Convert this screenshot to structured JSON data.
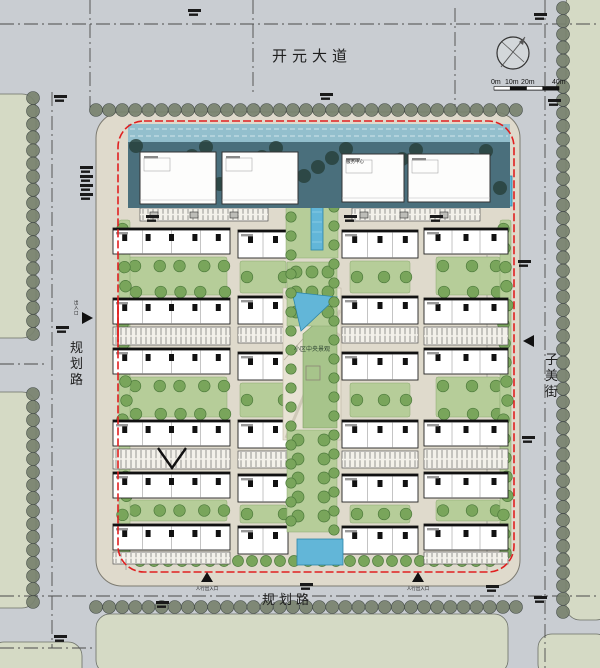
{
  "canvas": {
    "w": 600,
    "h": 668
  },
  "roads": {
    "top": "开元大道",
    "left": "规划路",
    "right": "子美街",
    "bottom": "规划路"
  },
  "scale_bar": {
    "ticks": [
      "0m",
      "10m",
      "20m",
      "40m"
    ]
  },
  "labels": {
    "central_landscape": "小区中央景观",
    "service_center": "服务中心",
    "entrance_west": "出入口",
    "entrance_pedestrian": "人行出入口"
  },
  "colors": {
    "road": "#c9cdd2",
    "parcel": "#d5dac5",
    "site": "#dfdacc",
    "green": "#b6cd99",
    "tree": "#79a55b",
    "tree_dark": "#4d7a3c",
    "scallop": "#79836f",
    "water": "#62b6d8",
    "water_edge": "#2e86a8",
    "teal": "#4a6f7c",
    "glass": "#93bfcd",
    "red": "#e02020",
    "building": "#ffffff",
    "ink": "#222222"
  },
  "geometry": {
    "parcels": [
      [
        -20,
        94,
        56,
        244
      ],
      [
        -20,
        392,
        56,
        216
      ],
      [
        566,
        -10,
        44,
        630
      ],
      [
        96,
        614,
        412,
        60
      ],
      [
        -10,
        642,
        92,
        40
      ],
      [
        538,
        634,
        72,
        44
      ]
    ],
    "dashdots": [
      [
        0,
        24,
        600,
        24
      ],
      [
        90,
        0,
        90,
        112
      ],
      [
        253,
        0,
        253,
        92
      ],
      [
        455,
        8,
        455,
        112
      ],
      [
        52,
        92,
        52,
        648
      ],
      [
        545,
        0,
        545,
        668
      ],
      [
        0,
        596,
        600,
        596
      ],
      [
        0,
        364,
        46,
        364
      ],
      [
        0,
        648,
        95,
        648
      ]
    ],
    "grid_dashes": [
      [
        126,
        228,
        126,
        570
      ],
      [
        487,
        228,
        487,
        570
      ]
    ],
    "scallops": [
      [
        96,
        110,
        516,
        110
      ],
      [
        96,
        607,
        516,
        607
      ],
      [
        33,
        98,
        33,
        334
      ],
      [
        33,
        394,
        33,
        602
      ],
      [
        563,
        8,
        563,
        612
      ]
    ],
    "green_rows": [
      [
        140,
        561,
        492,
        561
      ]
    ],
    "site": [
      96,
      112,
      424,
      474
    ],
    "boundary": [
      118,
      121,
      396,
      451
    ],
    "red_solid": [
      [
        118,
        300,
        118,
        342
      ]
    ],
    "teal_band": [
      128,
      142,
      382,
      66
    ],
    "glass_band": [
      128,
      124,
      382,
      18
    ],
    "commercial": [
      [
        140,
        152,
        76,
        52
      ],
      [
        222,
        152,
        76,
        52
      ],
      [
        342,
        154,
        62,
        48
      ],
      [
        408,
        154,
        82,
        48
      ]
    ],
    "buildings": [
      [
        113,
        228,
        117,
        26
      ],
      [
        113,
        298,
        117,
        26
      ],
      [
        113,
        348,
        117,
        26
      ],
      [
        113,
        420,
        117,
        26
      ],
      [
        113,
        472,
        117,
        26
      ],
      [
        113,
        524,
        117,
        26
      ],
      [
        238,
        230,
        50,
        28
      ],
      [
        238,
        296,
        50,
        28
      ],
      [
        238,
        352,
        50,
        28
      ],
      [
        238,
        420,
        50,
        28
      ],
      [
        238,
        474,
        50,
        28
      ],
      [
        238,
        526,
        50,
        28
      ],
      [
        342,
        230,
        76,
        28
      ],
      [
        342,
        296,
        76,
        28
      ],
      [
        342,
        352,
        76,
        28
      ],
      [
        342,
        420,
        76,
        28
      ],
      [
        342,
        474,
        76,
        28
      ],
      [
        342,
        526,
        76,
        28
      ],
      [
        424,
        228,
        84,
        26
      ],
      [
        424,
        298,
        84,
        26
      ],
      [
        424,
        348,
        84,
        26
      ],
      [
        424,
        420,
        84,
        26
      ],
      [
        424,
        472,
        84,
        26
      ],
      [
        424,
        524,
        84,
        26
      ]
    ],
    "greens": [
      [
        128,
        257,
        99,
        38
      ],
      [
        128,
        377,
        99,
        40
      ],
      [
        128,
        500,
        99,
        21
      ],
      [
        240,
        261,
        46,
        32
      ],
      [
        240,
        383,
        46,
        34
      ],
      [
        240,
        505,
        46,
        18
      ],
      [
        350,
        261,
        60,
        32
      ],
      [
        350,
        383,
        60,
        34
      ],
      [
        350,
        505,
        60,
        18
      ],
      [
        436,
        257,
        64,
        38
      ],
      [
        436,
        377,
        64,
        40
      ],
      [
        436,
        500,
        64,
        21
      ],
      [
        119,
        220,
        11,
        336
      ],
      [
        500,
        220,
        11,
        336
      ]
    ],
    "parkings": [
      [
        113,
        327,
        117,
        18
      ],
      [
        113,
        449,
        117,
        20
      ],
      [
        113,
        552,
        117,
        12
      ],
      [
        238,
        327,
        50,
        16
      ],
      [
        238,
        451,
        50,
        17
      ],
      [
        342,
        327,
        76,
        16
      ],
      [
        342,
        451,
        76,
        17
      ],
      [
        424,
        327,
        84,
        18
      ],
      [
        424,
        449,
        84,
        20
      ],
      [
        424,
        552,
        84,
        12
      ],
      [
        140,
        208,
        128,
        13
      ],
      [
        352,
        208,
        128,
        13
      ]
    ],
    "axis": {
      "flank_green": [
        286,
        128,
        52,
        130
      ],
      "canal": [
        311,
        146,
        12,
        104
      ],
      "plaza1": [
        287,
        262,
        50,
        64
      ],
      "central_plaza": "283,288 341,288 341,440 283,440",
      "tri_pool": "292,292 337,297 301,331",
      "wedge": "303,334 337,305 337,428 303,428",
      "plaza2": [
        287,
        430,
        50,
        102
      ],
      "pool_bottom": [
        297,
        539,
        46,
        26
      ],
      "pool_right": [
        502,
        176,
        10,
        30
      ],
      "gate_lines": [
        [
          304,
          204,
          321,
          150
        ],
        [
          321,
          150,
          338,
          204
        ],
        [
          309,
          204,
          321,
          162
        ],
        [
          321,
          162,
          333,
          204
        ]
      ]
    },
    "transformers": [
      [
        150,
        212
      ],
      [
        190,
        212
      ],
      [
        230,
        212
      ],
      [
        360,
        212
      ],
      [
        400,
        212
      ],
      [
        440,
        212
      ]
    ],
    "v_mark": "158,448 172,468 186,448",
    "micro": [
      [
        188,
        9
      ],
      [
        320,
        93
      ],
      [
        54,
        95
      ],
      [
        80,
        166
      ],
      [
        80,
        175
      ],
      [
        80,
        184
      ],
      [
        80,
        193
      ],
      [
        534,
        13
      ],
      [
        548,
        99
      ],
      [
        56,
        326
      ],
      [
        518,
        260
      ],
      [
        522,
        436
      ],
      [
        156,
        601
      ],
      [
        486,
        585
      ],
      [
        534,
        596
      ],
      [
        54,
        635
      ],
      [
        300,
        583
      ],
      [
        344,
        215
      ],
      [
        430,
        215
      ],
      [
        146,
        215
      ]
    ],
    "entrances": [
      {
        "x": 87,
        "y": 318,
        "dir": "right"
      },
      {
        "x": 529,
        "y": 341,
        "dir": "left"
      },
      {
        "x": 207,
        "y": 577,
        "dir": "up"
      },
      {
        "x": 418,
        "y": 577,
        "dir": "up"
      }
    ],
    "compass": {
      "cx": 513,
      "cy": 53,
      "r": 16
    },
    "scale_bar": {
      "x": 494,
      "y": 86.5,
      "seg": 16.25,
      "tick_y": 84
    }
  }
}
